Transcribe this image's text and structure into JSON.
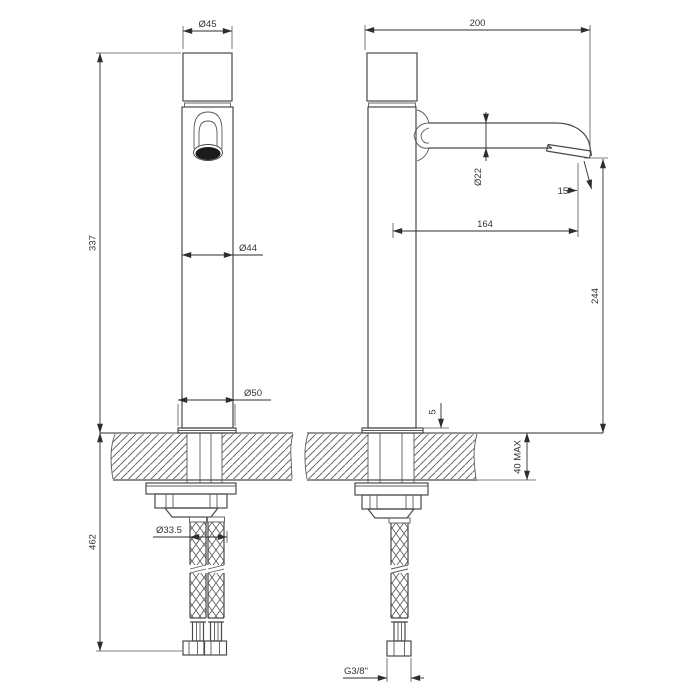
{
  "page": {
    "background": "#ffffff",
    "line_color": "#4a4a4a",
    "dimension_color": "#2e2e2e"
  },
  "front_view": {
    "dims": {
      "cap_diameter": "Ø45",
      "height_above_deck": "337",
      "body_diameter": "Ø44",
      "base_diameter": "Ø50",
      "hole_diameter": "Ø33.5",
      "length_below_deck": "462"
    }
  },
  "side_view": {
    "dims": {
      "depth": "200",
      "spout_diameter": "Ø22",
      "outlet_angle": "15°",
      "spout_reach": "164",
      "spout_height": "244",
      "base_plate_thickness": "5",
      "deck_thickness_max": "40 MAX",
      "hose_thread": "G3/8\""
    }
  }
}
